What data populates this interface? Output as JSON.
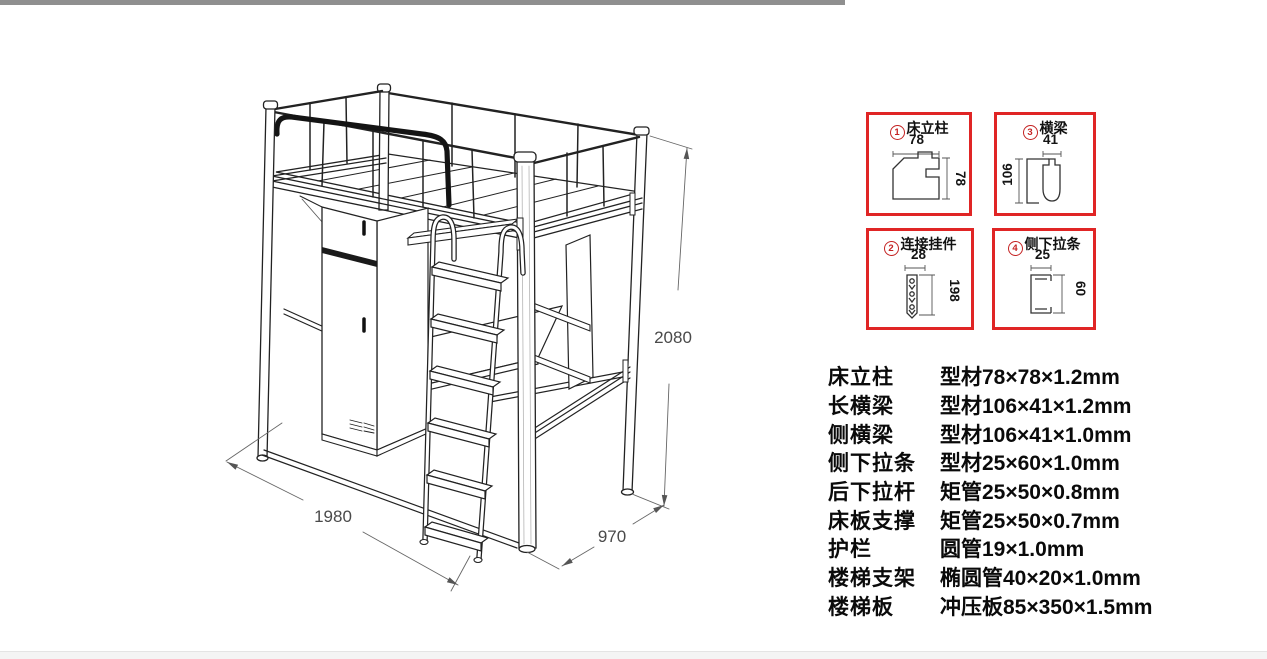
{
  "page": {
    "top_bar_color": "#8f8f8f",
    "bottom_bar_color": "#f4f4f4",
    "background": "#ffffff"
  },
  "drawing": {
    "dim_length": "1980",
    "dim_depth": "970",
    "dim_height": "2080"
  },
  "detail_boxes": [
    {
      "number": "1",
      "title": "床立柱",
      "dim_top": "78",
      "dim_side": "78"
    },
    {
      "number": "3",
      "title": "横梁",
      "dim_top": "41",
      "dim_side": "106"
    },
    {
      "number": "2",
      "title": "连接挂件",
      "dim_top": "28",
      "dim_side": "198"
    },
    {
      "number": "4",
      "title": "侧下拉条",
      "dim_top": "25",
      "dim_side": "60"
    }
  ],
  "spec_table": {
    "rows": [
      {
        "name": "床立柱",
        "value": "型材78×78×1.2mm"
      },
      {
        "name": "长横梁",
        "value": "型材106×41×1.2mm"
      },
      {
        "name": "侧横梁",
        "value": "型材106×41×1.0mm"
      },
      {
        "name": "侧下拉条",
        "value": "型材25×60×1.0mm"
      },
      {
        "name": "后下拉杆",
        "value": "矩管25×50×0.8mm"
      },
      {
        "name": "床板支撑",
        "value": "矩管25×50×0.7mm"
      },
      {
        "name": "护栏",
        "value": "圆管19×1.0mm"
      },
      {
        "name": "楼梯支架",
        "value": "椭圆管40×20×1.0mm"
      },
      {
        "name": "楼梯板",
        "value": "冲压板85×350×1.5mm"
      }
    ]
  },
  "colors": {
    "detail_box_border": "#e02525",
    "badge_red": "#c42222",
    "drawing_line": "#222222",
    "dimension_text": "#4a4a4a"
  }
}
